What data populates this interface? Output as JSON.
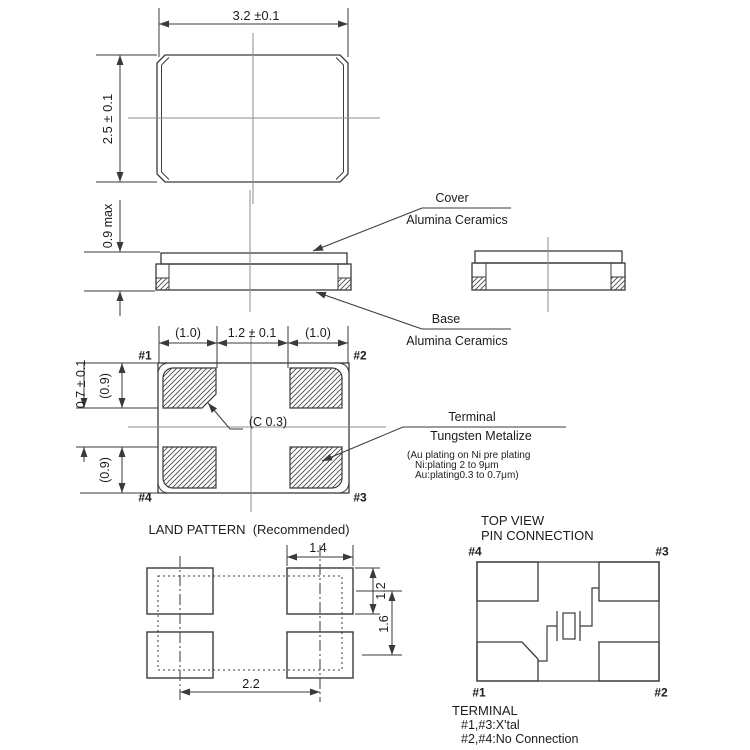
{
  "top_view": {
    "width_dim": "3.2 ±0.1",
    "height_dim": "2.5 ± 0.1"
  },
  "side_view": {
    "height_dim": "0.9 max",
    "cover_label": "Cover",
    "cover_material": "Alumina Ceramics",
    "base_label": "Base",
    "base_material": "Alumina Ceramics"
  },
  "bottom_view": {
    "dim_left_pad": "(1.0)",
    "dim_center": "1.2 ± 0.1",
    "dim_right_pad": "(1.0)",
    "dim_pad_len_top": "(0.9)",
    "dim_gap": "0.7 ± 0.1",
    "dim_pad_len_bottom": "(0.9)",
    "chamfer_note": "(C 0.3)",
    "pin1": "#1",
    "pin2": "#2",
    "pin3": "#3",
    "pin4": "#4",
    "terminal_label": "Terminal",
    "terminal_material": "Tungsten Metalize",
    "plating_note_lines": [
      "(Au plating on Ni pre plating",
      "Ni:plating 2 to 9μm",
      "Au:plating0.3 to 0.7μm)"
    ]
  },
  "land_pattern": {
    "title": "LAND PATTERN  (Recommended)",
    "dim_pad_width": "1.4",
    "dim_pad_height": "1.2",
    "dim_pitch_vertical": "1.6",
    "dim_pitch_horizontal": "2.2"
  },
  "pin_connection": {
    "title_line1": "TOP VIEW",
    "title_line2": "PIN CONNECTION",
    "pin1": "#1",
    "pin2": "#2",
    "pin3": "#3",
    "pin4": "#4",
    "legend_title": "TERMINAL",
    "legend_line1": "#1,#3:X'tal",
    "legend_line2": "#2,#4:No Connection"
  },
  "colors": {
    "line": "#3a3a3a",
    "centerline": "#8d8d8d",
    "text": "#1c1c1c",
    "background": "#ffffff"
  }
}
